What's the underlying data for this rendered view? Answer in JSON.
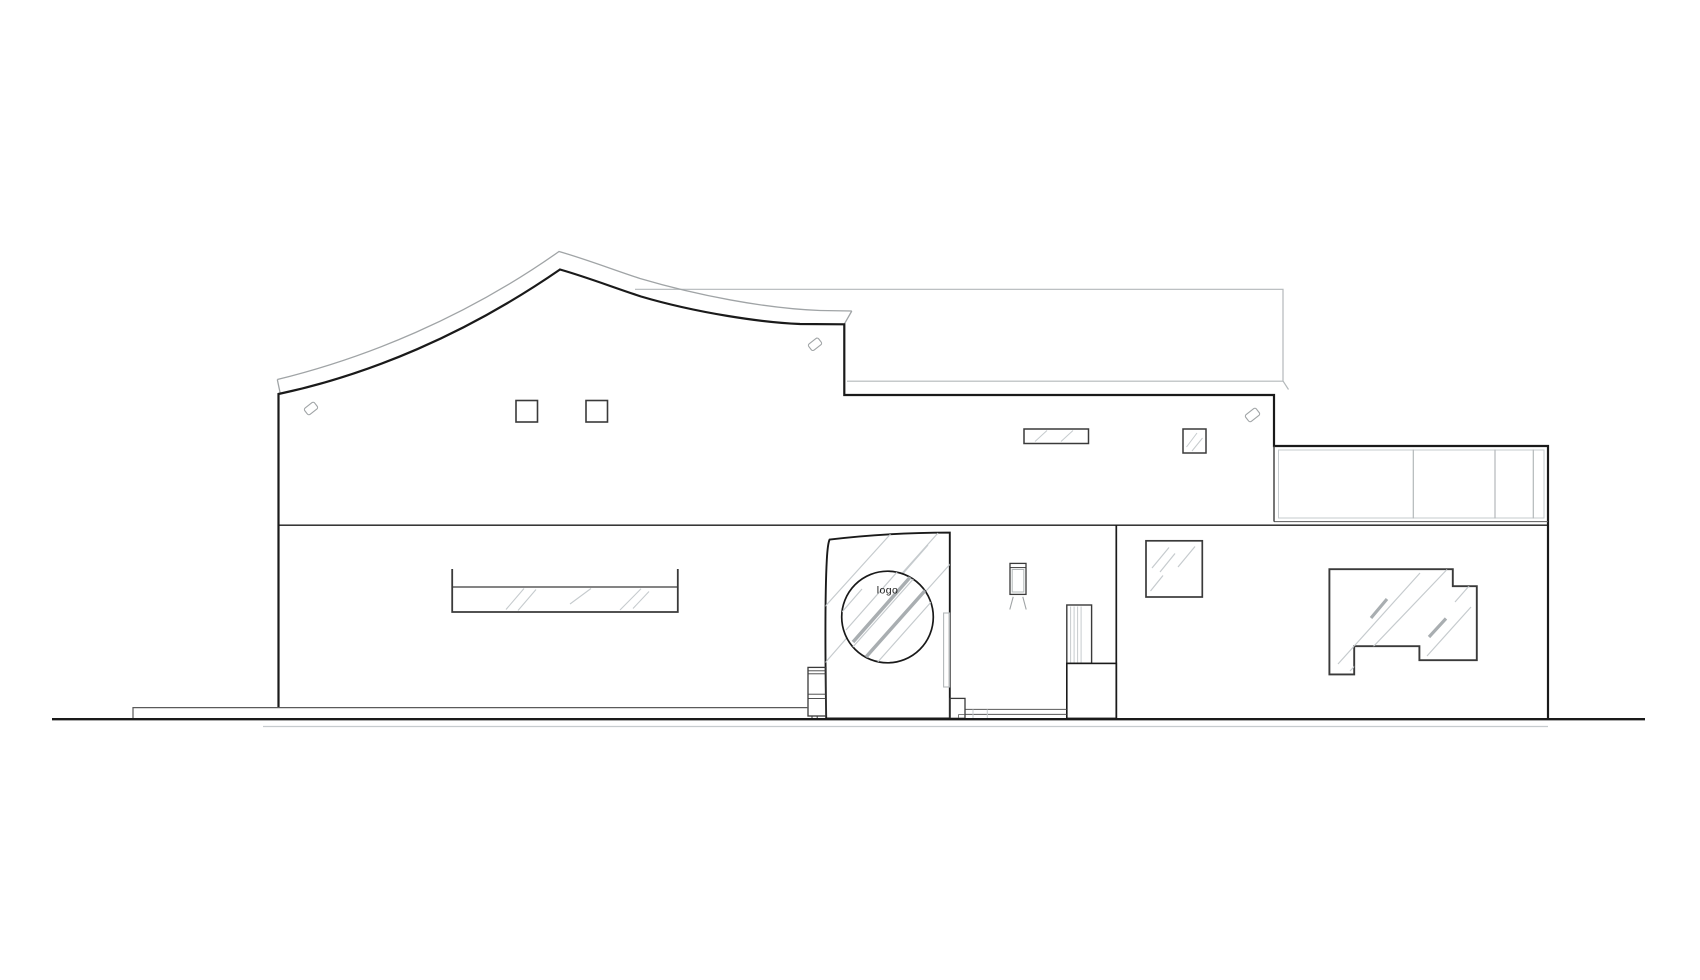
{
  "drawing": {
    "kind": "architectural front elevation line drawing",
    "portal": {
      "logo_label": "logo"
    }
  },
  "colors": {
    "background": "#ffffff",
    "ink": "#1a1a1a",
    "frame": "#3a3a3a",
    "soft": "#a0a4a6",
    "rear": "#b3b8ba",
    "glass": "#c6cbce",
    "glass_shadow": "#a9aeb1",
    "detail": "#5a5a5a"
  }
}
